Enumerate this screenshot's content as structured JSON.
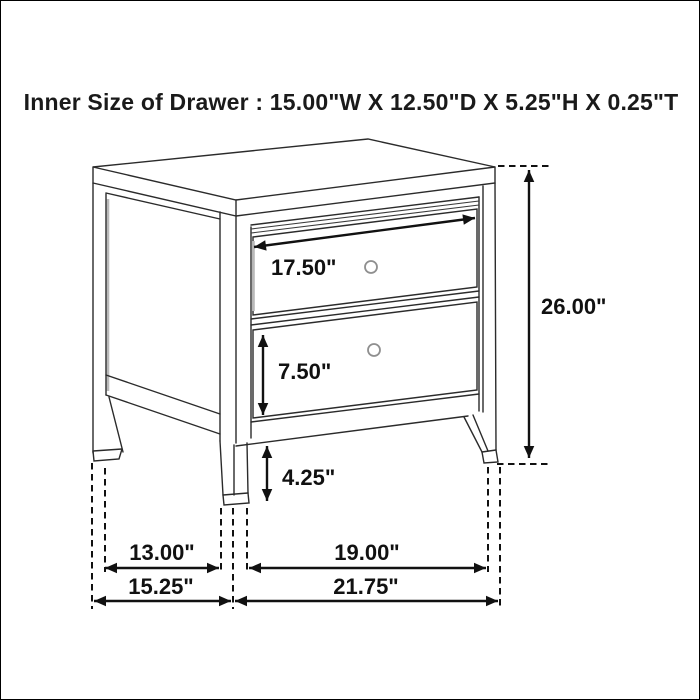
{
  "title": "Inner Size of Drawer : 15.00\"W X 12.50\"D X 5.25\"H X 0.25\"T",
  "diagram": {
    "subject": "two-drawer nightstand dimension line drawing",
    "line_color": "#2b2b2b",
    "labels": {
      "drawer_face_width": "17.50\"",
      "overall_height": "26.00\"",
      "bottom_drawer_face_height": "7.50\"",
      "leg_height": "4.25\"",
      "depth_between_legs": "13.00\"",
      "width_between_legs": "19.00\"",
      "overall_depth": "15.25\"",
      "overall_width": "21.75\""
    }
  }
}
